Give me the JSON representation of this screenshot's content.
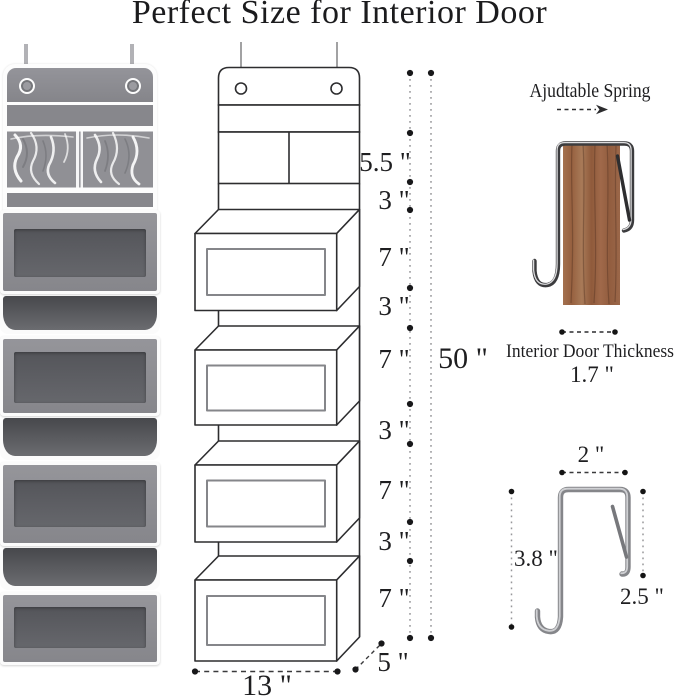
{
  "title": "Perfect Size for Interior Door",
  "middle": {
    "dims": [
      "5.5 \"",
      "3 \"",
      "7 \"",
      "3 \"",
      "7 \"",
      "3 \"",
      "7 \"",
      "3 \"",
      "7 \""
    ],
    "total_height": "50 \"",
    "width": "13 \"",
    "depth": "5 \""
  },
  "right": {
    "spring": "Ajudtable Spring",
    "thickness_label": "Interior Door Thickness",
    "thickness_value": "1.7 \"",
    "hook_top_width": "2 \"",
    "hook_long_side": "3.8 \"",
    "hook_short_side": "2.5 \""
  },
  "colors": {
    "fabric_gray": "#8c8c91",
    "window_gray": "#5f6065",
    "line_art": "#2d2d2f",
    "wood_brown": "#99664a",
    "metal_silver": "#b9babd",
    "text": "#1d1d1f"
  }
}
